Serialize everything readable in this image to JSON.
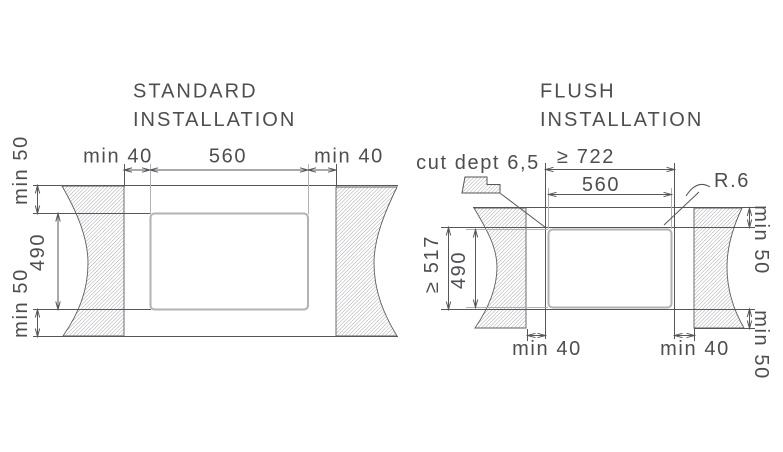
{
  "standard": {
    "title": [
      "STANDARD",
      "INSTALLATION"
    ],
    "dim_top_left": "min 40",
    "dim_top_center": "560",
    "dim_top_right": "min 40",
    "dim_left_top": "min 50",
    "dim_left_middle": "490",
    "dim_left_bottom": "min 50"
  },
  "flush": {
    "title": [
      "FLUSH",
      "INSTALLATION"
    ],
    "cut_depth": "cut dept 6,5",
    "dim_recess_width": "≥ 722",
    "dim_cutout_width": "560",
    "corner_radius": "R.6",
    "dim_recess_depth": "≥ 517",
    "dim_cutout_depth": "490",
    "dim_bottom_left": "min 40",
    "dim_bottom_right": "min 40",
    "dim_right_top": "min 50",
    "dim_right_bottom": "min 50"
  },
  "colors": {
    "line": "#55565a",
    "dimension_gray": "#b2b2b5",
    "text": "#4d4e52",
    "hatch": "#84848b",
    "background": "#ffffff"
  }
}
